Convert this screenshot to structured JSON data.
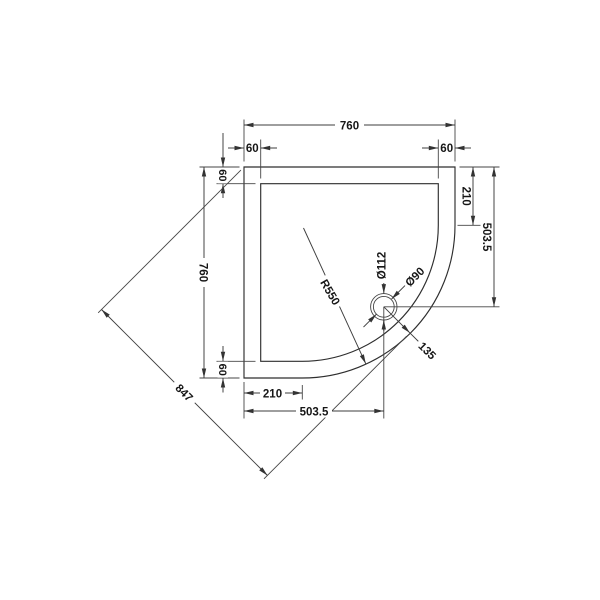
{
  "page": {
    "background": "#ffffff",
    "line_color": "#3d3d3d",
    "text_color": "#161616"
  },
  "drawing": {
    "type": "technical-dimension-drawing",
    "subject": "Quadrant shower tray plan view with waste hole",
    "labels": {
      "top_overall": "760",
      "top_rim_left": "60",
      "top_rim_right": "60",
      "left_rim_top": "60",
      "left_overall": "760",
      "left_rim_bottom": "60",
      "right_edge_to_curve": "210",
      "right_edge_to_waste": "503.5",
      "bottom_edge_to_curve": "210",
      "bottom_edge_to_waste": "503.5",
      "diagonal_overall": "847",
      "corner_radius": "R550",
      "waste_flange_dia": "Ø112",
      "waste_hole_dia": "Ø90",
      "waste_to_curved_edge": "135"
    }
  }
}
